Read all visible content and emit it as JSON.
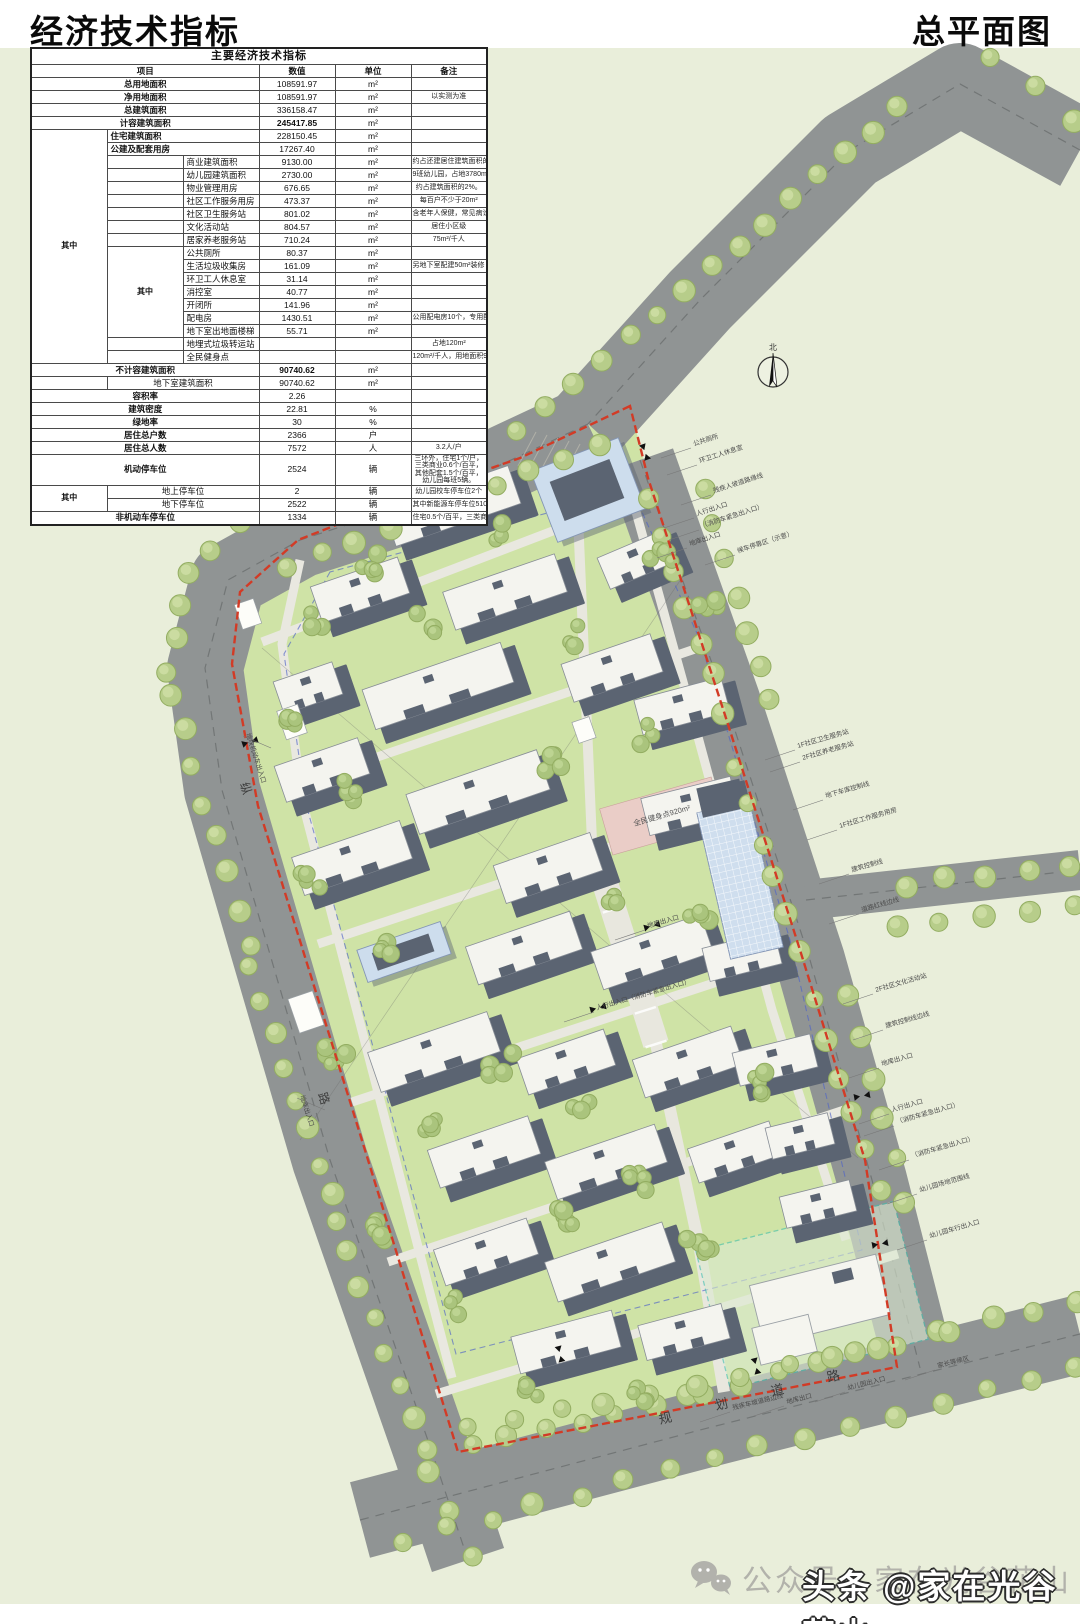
{
  "header": {
    "left_title": "经济技术指标",
    "right_title": "总平面图"
  },
  "watermark": {
    "account_text": "公众号：家在光谷花山",
    "overlay_text": "头条 @家在光谷花山"
  },
  "table": {
    "title": "主要经济技术指标",
    "columns": {
      "item": "项目",
      "value": "数值",
      "unit": "单位",
      "remark": "备注"
    },
    "among": "其中",
    "rows": [
      {
        "l": 0,
        "n": "总用地面积",
        "v": "108591.97",
        "u": "m²",
        "r": "",
        "b": 1
      },
      {
        "l": 0,
        "n": "净用地面积",
        "v": "108591.97",
        "u": "m²",
        "r": "以实测为准",
        "b": 1
      },
      {
        "l": 0,
        "n": "总建筑面积",
        "v": "336158.47",
        "u": "m²",
        "r": "",
        "b": 1
      },
      {
        "l": 0,
        "n": "计容建筑面积",
        "v": "245417.85",
        "u": "m²",
        "r": "",
        "b": 1,
        "vb": 1
      },
      {
        "l": 1,
        "n": "住宅建筑面积",
        "v": "228150.45",
        "u": "m²",
        "r": "",
        "b": 1
      },
      {
        "l": 1,
        "n": "公建及配套用房",
        "v": "17267.40",
        "u": "m²",
        "r": "",
        "b": 1
      },
      {
        "l": 2,
        "n": "商业建筑面积",
        "v": "9130.00",
        "u": "m²",
        "r": "约占还建居住建筑面积的4%，含2250m²超市型集贸市场"
      },
      {
        "l": 2,
        "n": "幼儿园建筑面积",
        "v": "2730.00",
        "u": "m²",
        "r": "9班幼儿园，占地3780m²"
      },
      {
        "l": 2,
        "n": "物业管理用房",
        "v": "676.65",
        "u": "m²",
        "r": "约占建筑面积的2%。"
      },
      {
        "l": 2,
        "n": "社区工作服务用房",
        "v": "473.37",
        "u": "m²",
        "r": "每百户不少于20m²"
      },
      {
        "l": 2,
        "n": "社区卫生服务站",
        "v": "801.02",
        "u": "m²",
        "r": "含老年人保健，常见病诊疗，残疾人康复中心"
      },
      {
        "l": 2,
        "n": "文化活动站",
        "v": "804.57",
        "u": "m²",
        "r": "居住小区级"
      },
      {
        "l": 2,
        "n": "居家养老服务站",
        "v": "710.24",
        "u": "m²",
        "r": "75m²/千人"
      },
      {
        "l": 3,
        "n": "公共厕所",
        "v": "80.37",
        "u": "m²",
        "r": ""
      },
      {
        "l": 3,
        "n": "生活垃圾收集房",
        "v": "161.09",
        "u": "m²",
        "r": "另地下室配建50m²装修（大件）垃圾收集房"
      },
      {
        "l": 3,
        "n": "环卫工人休息室",
        "v": "31.14",
        "u": "m²",
        "r": ""
      },
      {
        "l": 3,
        "n": "消控室",
        "v": "40.77",
        "u": "m²",
        "r": ""
      },
      {
        "l": 3,
        "n": "开闭所",
        "v": "141.96",
        "u": "m²",
        "r": ""
      },
      {
        "l": 3,
        "n": "配电房",
        "v": "1430.51",
        "u": "m²",
        "r": "公用配电房10个，专用配电房2个"
      },
      {
        "l": 3,
        "n": "地下室出地面楼梯",
        "v": "55.71",
        "u": "m²",
        "r": ""
      },
      {
        "l": 2,
        "n": "地埋式垃圾转运站",
        "v": "",
        "u": "",
        "r": "占地120m²"
      },
      {
        "l": 2,
        "n": "全民健身点",
        "v": "",
        "u": "",
        "r": "120m²/千人，用地面积920m²"
      },
      {
        "l": 0,
        "n": "不计容建筑面积",
        "v": "90740.62",
        "u": "m²",
        "r": "",
        "b": 1,
        "vb": 1
      },
      {
        "l": 9,
        "n": "地下室建筑面积",
        "v": "90740.62",
        "u": "m²",
        "r": ""
      },
      {
        "l": 0,
        "n": "容积率",
        "v": "2.26",
        "u": "",
        "r": "",
        "b": 1
      },
      {
        "l": 0,
        "n": "建筑密度",
        "v": "22.81",
        "u": "%",
        "r": "",
        "b": 1
      },
      {
        "l": 0,
        "n": "绿地率",
        "v": "30",
        "u": "%",
        "r": "",
        "b": 1
      },
      {
        "l": 0,
        "n": "居住总户数",
        "v": "2366",
        "u": "户",
        "r": "",
        "b": 1
      },
      {
        "l": 0,
        "n": "居住总人数",
        "v": "7572",
        "u": "人",
        "r": "3.2人/户",
        "b": 1
      },
      {
        "l": 0,
        "n": "机动停车位",
        "v": "2524",
        "u": "辆",
        "r": "三环外，住宅1个/户，三类商业0.6个/百平，其他配套1.5个/百平，幼儿园每班5辆。",
        "b": 1,
        "h2": 1
      },
      {
        "l": 4,
        "n": "地上停车位",
        "v": "2",
        "u": "辆",
        "r": "幼儿园校车停车位2个"
      },
      {
        "l": 4,
        "n": "地下停车位",
        "v": "2522",
        "u": "辆",
        "r": "其中新能源车停车位510个"
      },
      {
        "l": 0,
        "n": "非机动车停车位",
        "v": "1334",
        "u": "辆",
        "r": "住宅0.5个/百平，三类商业1.5个/百平，其他配套1.5个/百平",
        "b": 1
      }
    ]
  },
  "map": {
    "colors": {
      "bg": "#e9eeda",
      "site": "#cfe3a6",
      "road": "#909494",
      "centerline": "#6d7171",
      "path": "#e9e8e0",
      "tree_fill": "#b7cd8a",
      "tree_stroke": "#93ad61",
      "tree_hi": "#cbdca1",
      "bldg_dark": "#5b6472",
      "bldg_roof": "#f4f4ef",
      "bldg_stroke": "#878d96",
      "blue_fill": "#cddded",
      "blue_stroke": "#8496b5",
      "boundary": "#d23b26",
      "blue_dash": "#4f63c8",
      "teal": "#3fbfae",
      "pink": "#eacdc7",
      "label": "#4a4a4a"
    },
    "roads": [
      {
        "pts": [
          [
            1080,
            150
          ],
          [
            960,
            84
          ],
          [
            850,
            150
          ],
          [
            700,
            300
          ],
          [
            588,
            424
          ]
        ],
        "w": 82
      },
      {
        "pts": [
          [
            588,
            424
          ],
          [
            430,
            498
          ],
          [
            300,
            540
          ],
          [
            228,
            580
          ],
          [
            205,
            668
          ],
          [
            222,
            790
          ],
          [
            330,
            1160
          ],
          [
            432,
            1452
          ],
          [
            468,
            1560
          ]
        ],
        "w": 76
      },
      {
        "pts": [
          [
            640,
            460
          ],
          [
            725,
            700
          ],
          [
            810,
            960
          ],
          [
            872,
            1180
          ],
          [
            920,
            1368
          ]
        ],
        "w": 70
      },
      {
        "pts": [
          [
            806,
            900
          ],
          [
            1080,
            870
          ]
        ],
        "w": 40
      },
      {
        "pts": [
          [
            360,
            1520
          ],
          [
            700,
            1430
          ],
          [
            1080,
            1334
          ]
        ],
        "w": 78
      }
    ],
    "boundary": [
      [
        630,
        406
      ],
      [
        520,
        458
      ],
      [
        400,
        500
      ],
      [
        298,
        540
      ],
      [
        240,
        592
      ],
      [
        232,
        664
      ],
      [
        258,
        806
      ],
      [
        352,
        1108
      ],
      [
        458,
        1452
      ],
      [
        897,
        1367
      ],
      [
        865,
        1160
      ],
      [
        800,
        950
      ],
      [
        725,
        715
      ],
      [
        648,
        478
      ]
    ],
    "inner_paths": [
      [
        [
          300,
          560
        ],
        [
          282,
          644
        ],
        [
          302,
          800
        ],
        [
          380,
          1100
        ],
        [
          452,
          1378
        ]
      ],
      [
        [
          625,
          472
        ],
        [
          688,
          700
        ],
        [
          772,
          1010
        ],
        [
          846,
          1240
        ]
      ],
      [
        [
          262,
          642
        ],
        [
          618,
          506
        ]
      ],
      [
        [
          286,
          788
        ],
        [
          698,
          648
        ]
      ],
      [
        [
          318,
          944
        ],
        [
          746,
          802
        ]
      ],
      [
        [
          352,
          1102
        ],
        [
          790,
          958
        ]
      ],
      [
        [
          388,
          1262
        ],
        [
          850,
          1108
        ]
      ],
      [
        [
          436,
          1394
        ],
        [
          898,
          1254
        ]
      ]
    ],
    "axes": [
      {
        "pts": [
          [
            576,
            470
          ],
          [
            592,
            842
          ]
        ],
        "w": 10
      },
      {
        "pts": [
          [
            592,
            842
          ],
          [
            656,
            1044
          ]
        ],
        "w": 26
      },
      {
        "pts": [
          [
            656,
            1044
          ],
          [
            700,
            1250
          ],
          [
            724,
            1392
          ]
        ],
        "w": 12
      }
    ],
    "blue_dash": [
      [
        330,
        572
      ],
      [
        284,
        654
      ],
      [
        306,
        804
      ],
      [
        386,
        1094
      ],
      [
        456,
        1354
      ],
      [
        862,
        1250
      ],
      [
        790,
        940
      ],
      [
        700,
        640
      ],
      [
        632,
        490
      ]
    ],
    "survey": [
      [
        [
          262,
          648
        ],
        [
          858,
          1158
        ]
      ],
      [
        [
          300,
          1140
        ],
        [
          690,
          566
        ]
      ]
    ],
    "hatch": {
      "x": 536,
      "y": 432,
      "n": 6
    },
    "buildings": [
      [
        452,
        506,
        132,
        40
      ],
      [
        360,
        590,
        92,
        38
      ],
      [
        505,
        592,
        118,
        40
      ],
      [
        636,
        560,
        70,
        34,
        -23
      ],
      [
        308,
        688,
        62,
        34
      ],
      [
        438,
        686,
        146,
        42
      ],
      [
        612,
        668,
        94,
        40
      ],
      [
        682,
        706,
        90,
        36,
        -15
      ],
      [
        322,
        770,
        88,
        38
      ],
      [
        478,
        792,
        138,
        42
      ],
      [
        690,
        806,
        92,
        38,
        -14
      ],
      [
        352,
        858,
        114,
        40
      ],
      [
        548,
        868,
        102,
        40
      ],
      [
        524,
        948,
        110,
        40
      ],
      [
        652,
        952,
        116,
        40
      ],
      [
        742,
        956,
        74,
        34,
        -14
      ],
      [
        434,
        1052,
        126,
        42
      ],
      [
        566,
        1062,
        92,
        38
      ],
      [
        688,
        1062,
        104,
        40
      ],
      [
        775,
        1060,
        80,
        34,
        -14
      ],
      [
        484,
        1152,
        106,
        40
      ],
      [
        606,
        1162,
        116,
        40
      ],
      [
        734,
        1152,
        86,
        36
      ],
      [
        800,
        1136,
        64,
        32,
        -14
      ],
      [
        486,
        1252,
        98,
        38
      ],
      [
        610,
        1262,
        124,
        42
      ],
      [
        818,
        1204,
        72,
        32,
        -14
      ],
      [
        566,
        1342,
        104,
        38,
        -15
      ],
      [
        684,
        1332,
        86,
        36,
        -15
      ]
    ],
    "blue_buildings": [
      [
        588,
        490,
        94,
        76,
        -21
      ],
      [
        404,
        952,
        88,
        34,
        -19
      ]
    ],
    "market": [
      740,
      880,
      54,
      150,
      -13
    ],
    "kindergarten": {
      "bldg": [
        820,
        1300,
        130,
        62,
        -14
      ],
      "wing": [
        776,
        1330,
        58,
        38,
        -14
      ],
      "zone": [
        812,
        1295,
        204,
        142,
        -14
      ]
    },
    "service": [
      [
        292,
        722,
        22,
        30
      ],
      [
        306,
        1012,
        26,
        36
      ],
      [
        248,
        614,
        20,
        26
      ],
      [
        584,
        730,
        18,
        22
      ]
    ],
    "fitness": {
      "rect": [
        662,
        816,
        116,
        48,
        -16
      ],
      "label": "全民健身点920m²"
    },
    "tree_lines": [
      [
        520,
        428,
        900,
        108,
        15
      ],
      [
        990,
        58,
        1075,
        120,
        3
      ],
      [
        300,
        470,
        212,
        548,
        4
      ],
      [
        186,
        572,
        168,
        672,
        4
      ],
      [
        172,
        696,
        248,
        944,
        8
      ],
      [
        252,
        968,
        330,
        1196,
        8
      ],
      [
        336,
        1220,
        424,
        1448,
        8
      ],
      [
        430,
        1470,
        470,
        1556,
        3
      ],
      [
        286,
        566,
        598,
        446,
        10
      ],
      [
        652,
        500,
        722,
        712,
        7
      ],
      [
        738,
        770,
        800,
        950,
        6
      ],
      [
        815,
        1000,
        880,
        1190,
        6
      ],
      [
        702,
        492,
        770,
        700,
        7
      ],
      [
        848,
        995,
        905,
        1200,
        6
      ],
      [
        905,
        884,
        1070,
        864,
        5
      ],
      [
        895,
        928,
        1072,
        908,
        5
      ],
      [
        470,
        1448,
        690,
        1396,
        7
      ],
      [
        700,
        1394,
        935,
        1334,
        7
      ],
      [
        950,
        1330,
        1075,
        1300,
        4
      ],
      [
        400,
        1540,
        1075,
        1368,
        16
      ],
      [
        470,
        1430,
        880,
        1346,
        10
      ]
    ],
    "tree_clusters": [
      [
        312,
        618
      ],
      [
        368,
        562
      ],
      [
        425,
        625
      ],
      [
        288,
        724
      ],
      [
        352,
        790
      ],
      [
        310,
        884
      ],
      [
        388,
        952
      ],
      [
        336,
        1052
      ],
      [
        424,
        1124
      ],
      [
        372,
        1232
      ],
      [
        452,
        1304
      ],
      [
        530,
        1388
      ],
      [
        636,
        1390
      ],
      [
        508,
        532
      ],
      [
        566,
        636
      ],
      [
        640,
        736
      ],
      [
        548,
        764
      ],
      [
        604,
        904
      ],
      [
        700,
        924
      ],
      [
        756,
        1084
      ],
      [
        640,
        1184
      ],
      [
        566,
        1214
      ],
      [
        700,
        1244
      ],
      [
        502,
        1064
      ],
      [
        584,
        1112
      ],
      [
        662,
        560
      ],
      [
        712,
        612
      ]
    ],
    "labels": [
      [
        "公共厕所",
        694,
        446,
        -18
      ],
      [
        "环卫工人休息室",
        700,
        463,
        -18
      ],
      [
        "残疾人坡道路缘线",
        714,
        493,
        -18
      ],
      [
        "人行出入口",
        697,
        516,
        -18
      ],
      [
        "（消防车紧急出入口）",
        702,
        528,
        -18
      ],
      [
        "地库出入口",
        690,
        546,
        -18
      ],
      [
        "候车停靠区（示意）",
        738,
        553,
        -18
      ],
      [
        "1F社区卫生服务站",
        798,
        748,
        -16
      ],
      [
        "2F社区养老服务站",
        803,
        760,
        -16
      ],
      [
        "地下车库控制线",
        826,
        798,
        -16
      ],
      [
        "1F社区工作服务用房",
        840,
        828,
        -16
      ],
      [
        "建筑控制线",
        852,
        872,
        -16
      ],
      [
        "道路红线边线",
        862,
        912,
        -16
      ],
      [
        "2F社区文化活动站",
        876,
        992,
        -16
      ],
      [
        "建筑控制线边线",
        886,
        1028,
        -16
      ],
      [
        "地库出入口",
        882,
        1066,
        -16
      ],
      [
        "人行出入口",
        892,
        1112,
        -16
      ],
      [
        "（消防车紧急出入口）",
        897,
        1124,
        -16
      ],
      [
        "（消防车紧急出入口）",
        912,
        1158,
        -16
      ],
      [
        "幼儿园场地范围线",
        920,
        1192,
        -16
      ],
      [
        "幼儿园车行出入口",
        930,
        1238,
        -16
      ],
      [
        "家长等候区",
        938,
        1368,
        -14
      ],
      [
        "幼儿园出入口",
        848,
        1390,
        -14
      ],
      [
        "残疾车坡道路边线",
        733,
        1410,
        -14
      ],
      [
        "地库出口",
        787,
        1404,
        -14
      ],
      [
        "地库出入口",
        648,
        928,
        -16
      ],
      [
        "人行出入口（消防车紧急出入口）",
        597,
        1010,
        -16
      ],
      [
        "地块机动车出入口",
        246,
        734,
        72,
        28,
        12
      ],
      [
        "地库出入口",
        300,
        1096,
        72,
        28,
        12
      ]
    ],
    "arrows": [
      [
        652,
        926,
        75
      ],
      [
        598,
        1008,
        75
      ],
      [
        250,
        742,
        72
      ],
      [
        756,
        1366,
        -14
      ],
      [
        862,
        1096,
        -100
      ],
      [
        880,
        1244,
        -100
      ],
      [
        560,
        1354,
        -14
      ],
      [
        645,
        452,
        -20
      ]
    ],
    "compass": {
      "x": 773,
      "y": 372,
      "label": "北"
    },
    "road_names": {
      "bottom": [
        [
          "规",
          660,
          1424
        ],
        [
          "划",
          716,
          1410
        ],
        [
          "道",
          772,
          1396
        ],
        [
          "路",
          828,
          1382
        ]
      ],
      "left": [
        [
          "纵",
          240,
          784
        ],
        [
          "路",
          318,
          1094
        ]
      ]
    }
  }
}
